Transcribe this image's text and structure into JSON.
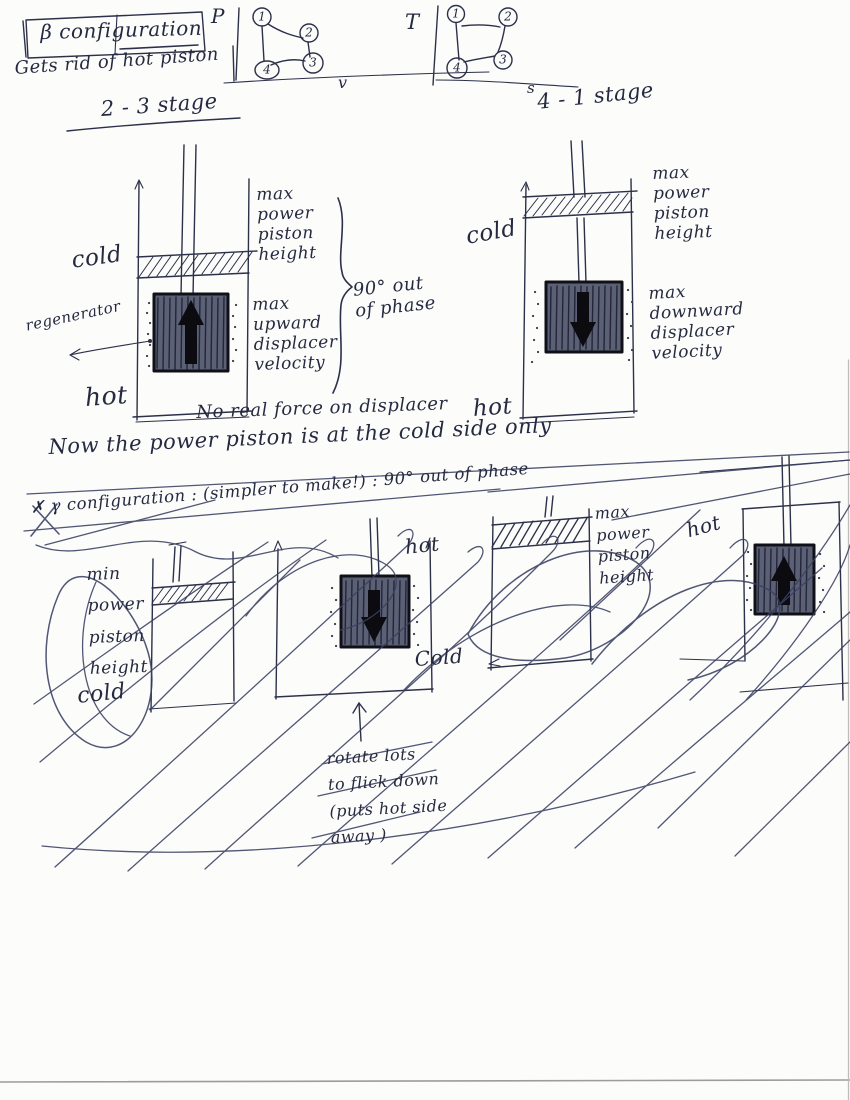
{
  "colors": {
    "ink": "#262a40",
    "paper": "#fcfcfb",
    "displacer_fill": "#5b6074",
    "arrow_fill": "#0b0b10"
  },
  "header": {
    "config_box": "β configuration",
    "subtitle": "Gets rid of hot piston"
  },
  "pv_chart": {
    "y_axis": "P",
    "x_axis": "v",
    "points": [
      "1",
      "2",
      "3",
      "4"
    ]
  },
  "ts_chart": {
    "y_axis": "T",
    "x_axis": "s",
    "points": [
      "1",
      "2",
      "3",
      "4"
    ]
  },
  "stage_23": {
    "title": "2 - 3 stage",
    "cold": "cold",
    "regenerator": "regenerator",
    "hot": "hot",
    "piston_note": "max\npower\npiston\nheight",
    "displacer_note": "max\nupward\ndisplacer\nvelocity",
    "phase_note": "90° out\nof phase"
  },
  "stage_41": {
    "title": "4 - 1 stage",
    "cold": "cold",
    "hot": "hot",
    "piston_note": "max\npower\npiston\nheight",
    "displacer_note": "max\ndownward\ndisplacer\nvelocity"
  },
  "notes": {
    "force_note": "No real force on displacer",
    "cold_side_note": "Now the power piston is at the cold side only"
  },
  "gamma_section": {
    "struck_heading": "✗ γ configuration : (simpler to make!) : 90° out of phase",
    "piston_note": "min\npower\npiston\nheight",
    "cold_left": "cold",
    "hot_mid": "hot",
    "cold_mid": "Cold",
    "rotate_note": "rotate lots\nto flick down\n(puts hot side\naway )",
    "max_piston_note": "max\npower\npiston\nheight",
    "hot_right": "hot"
  }
}
